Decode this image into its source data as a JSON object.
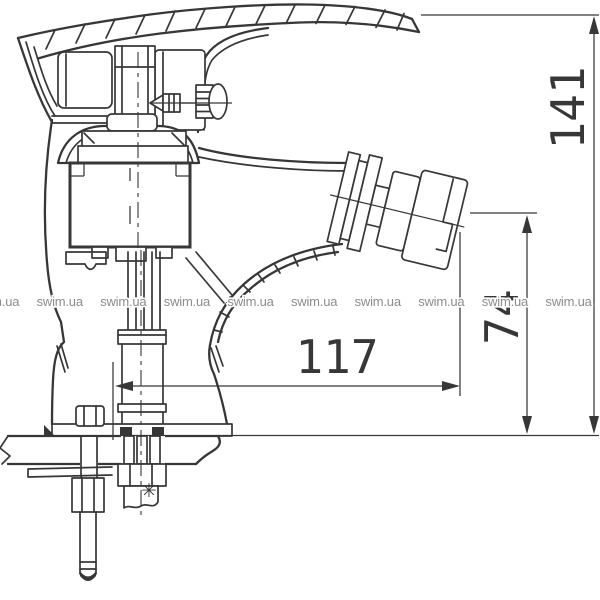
{
  "drawing": {
    "line_color": "#373737",
    "dimensions": {
      "overall_height": "141",
      "outlet_height": "74",
      "spout_reach": "117"
    },
    "symbols": {
      "hose_marker": "✳"
    }
  },
  "watermark": {
    "text": "swim.ua",
    "color": "#8c8c8c",
    "count": 10
  }
}
